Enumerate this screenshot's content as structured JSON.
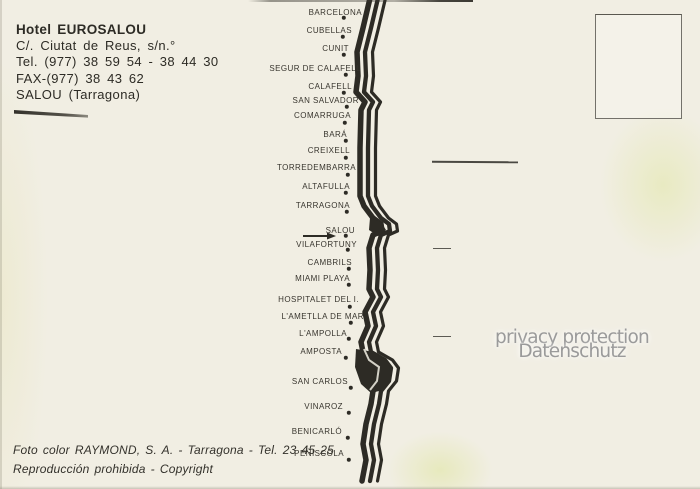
{
  "card": {
    "hotel": {
      "name": "Hotel EUROSALOU",
      "address": "C/. Ciutat de Reus, s/n.°",
      "phone": "Tel. (977) 38 59 54 - 38 44 30",
      "fax": "FAX-(977) 38 43 62",
      "city": "SALOU (Tarragona)"
    },
    "credits": {
      "photo": "Foto color RAYMOND, S. A. - Tarragona - Tel. 23 45 25",
      "copyright": "Reproducción prohibida - Copyright"
    },
    "watermark": {
      "line1": "privacy protection",
      "line2": "Datenschutz"
    },
    "map": {
      "arrow_target": "SALOU",
      "towns": [
        {
          "name": "BARCELONA",
          "top": 9,
          "right": 362,
          "dot": [
            344,
            18
          ]
        },
        {
          "name": "CUBELLAS",
          "top": 27,
          "right": 352,
          "dot": [
            343,
            37
          ]
        },
        {
          "name": "CUNIT",
          "top": 45,
          "right": 349,
          "dot": [
            344,
            55
          ]
        },
        {
          "name": "SEGUR DE CALAFELL",
          "top": 65,
          "right": 361,
          "dot": [
            346,
            75
          ]
        },
        {
          "name": "CALAFELL",
          "top": 83,
          "right": 352,
          "dot": [
            344,
            93
          ]
        },
        {
          "name": "SAN SALVADOR",
          "top": 97,
          "right": 359,
          "dot": [
            347,
            107
          ]
        },
        {
          "name": "COMARRUGA",
          "top": 112,
          "right": 351,
          "dot": [
            345,
            123
          ]
        },
        {
          "name": "BARÁ",
          "top": 131,
          "right": 347,
          "dot": [
            346,
            141
          ]
        },
        {
          "name": "CREIXELL",
          "top": 147,
          "right": 350,
          "dot": [
            346,
            158
          ]
        },
        {
          "name": "TORREDEMBARRA",
          "top": 164,
          "right": 356,
          "dot": [
            348,
            175
          ]
        },
        {
          "name": "ALTAFULLA",
          "top": 183,
          "right": 350,
          "dot": [
            346,
            193
          ]
        },
        {
          "name": "TARRAGONA",
          "top": 202,
          "right": 350,
          "dot": [
            347,
            212
          ]
        },
        {
          "name": "SALOU",
          "top": 227,
          "right": 355,
          "dot": [
            346,
            236
          ]
        },
        {
          "name": "VILAFORTUNY",
          "top": 241,
          "right": 357,
          "dot": [
            348,
            250
          ]
        },
        {
          "name": "CAMBRILS",
          "top": 259,
          "right": 352,
          "dot": [
            349,
            269
          ]
        },
        {
          "name": "MIAMI PLAYA",
          "top": 275,
          "right": 350,
          "dot": [
            349,
            285
          ]
        },
        {
          "name": "HOSPITALET DEL I.",
          "top": 296,
          "right": 359,
          "dot": [
            350,
            307
          ]
        },
        {
          "name": "L'AMETLLA DE MAR",
          "top": 313,
          "right": 364,
          "dot": [
            351,
            323
          ]
        },
        {
          "name": "L'AMPOLLA",
          "top": 330,
          "right": 347,
          "dot": [
            349,
            339
          ]
        },
        {
          "name": "AMPOSTA",
          "top": 348,
          "right": 342,
          "dot": [
            346,
            358
          ]
        },
        {
          "name": "SAN CARLOS",
          "top": 378,
          "right": 348,
          "dot": [
            351,
            388
          ]
        },
        {
          "name": "VINAROZ",
          "top": 403,
          "right": 343,
          "dot": [
            349,
            413
          ]
        },
        {
          "name": "BENICARLÓ",
          "top": 428,
          "right": 342,
          "dot": [
            348,
            438
          ]
        },
        {
          "name": "PEÑISCOLA",
          "top": 450,
          "right": 344,
          "dot": [
            349,
            460
          ]
        }
      ]
    },
    "colors": {
      "paper": "#f1eee3",
      "ink": "#2d2b25",
      "label_ink": "#38352e",
      "watermark": "#9a9a9a"
    }
  }
}
